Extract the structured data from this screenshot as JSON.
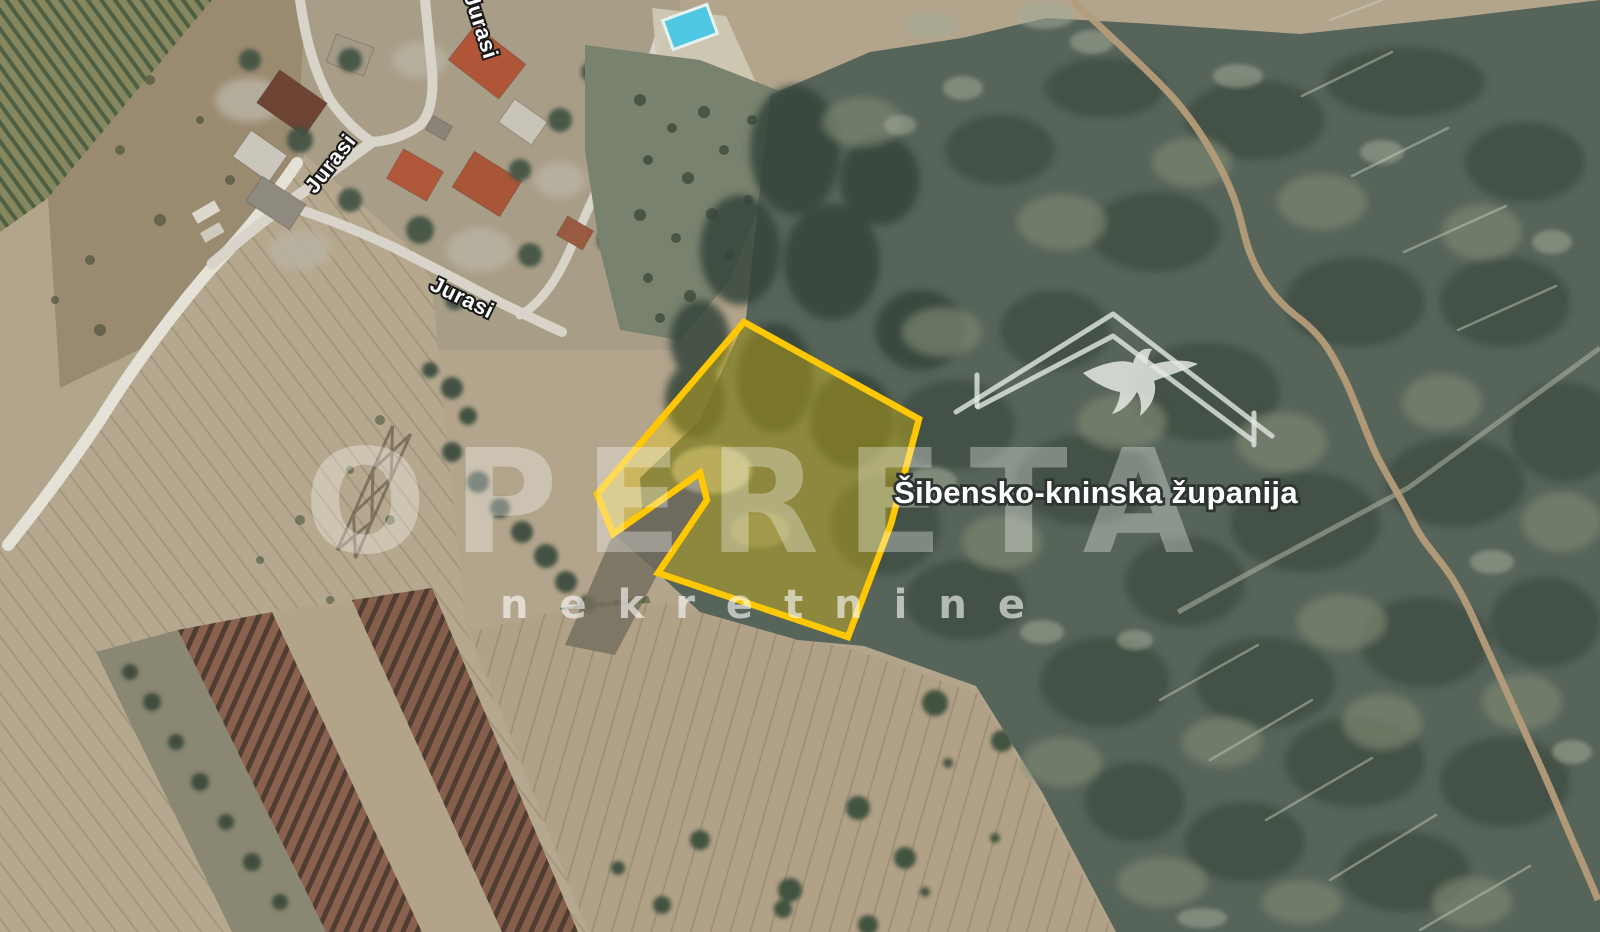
{
  "map": {
    "type": "satellite-imagery",
    "region_label": "Šibensko-kninska županija",
    "street_labels": [
      {
        "text": "Jurasi"
      },
      {
        "text": "Jurasi"
      },
      {
        "text": "Jurasi"
      }
    ]
  },
  "watermark": {
    "brand": "OPERETA",
    "subtitle": "nekretnine",
    "logo_icon": "roof-swallow-icon"
  },
  "parcel_overlay": {
    "stroke_color": "#ffc800",
    "fill_color": "rgba(255,215,0,0.32)"
  },
  "palette": {
    "field_tan": "#b3a58c",
    "scrub_green": "#57645a",
    "road_light": "#e3e0d6",
    "pool_blue": "#4fc8e4",
    "roof_red": "#ad5839",
    "label_white": "#ffffff",
    "label_outline": "#2e3531"
  }
}
